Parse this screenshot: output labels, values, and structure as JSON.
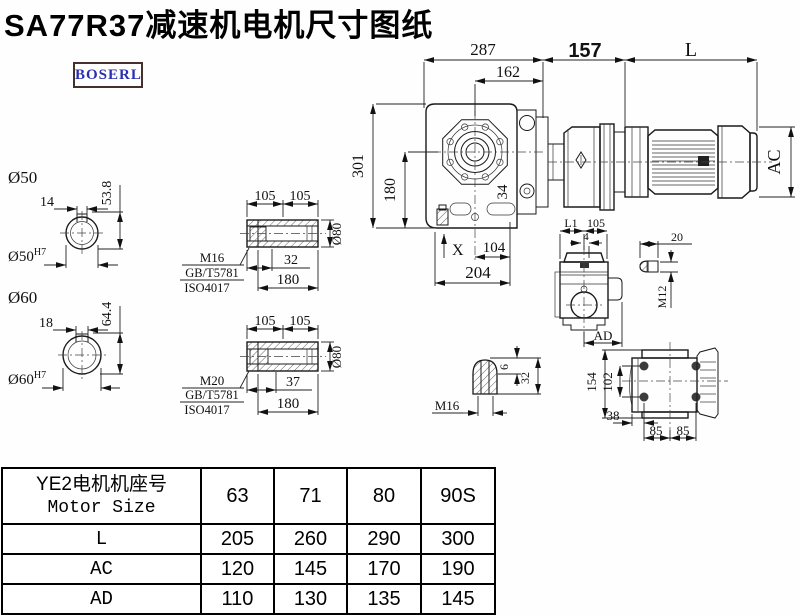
{
  "title": "SA77R37减速机电机尺寸图纸",
  "logo_text": "BOSERL",
  "main_view": {
    "dim_287": "287",
    "dim_162": "162",
    "dim_157": "157",
    "dim_L": "L",
    "dim_301": "301",
    "dim_180": "180",
    "dim_X": "X",
    "dim_104": "104",
    "dim_204": "204",
    "dim_34": "34",
    "dim_AC": "AC"
  },
  "shaft_section_50": {
    "label": "Ø50",
    "key_width": "14",
    "height": "53.8",
    "bore": "Ø50",
    "bore_tol": "H7"
  },
  "shaft_section_60": {
    "label": "Ø60",
    "key_width": "18",
    "height": "64.4",
    "bore": "Ø60",
    "bore_tol": "H7"
  },
  "hollow_shaft_1": {
    "dim_a": "105",
    "dim_b": "105",
    "thread": "M16",
    "std_1": "GB/T5781",
    "std_2": "ISO4017",
    "depth": "32",
    "length": "180",
    "dia": "Ø80"
  },
  "hollow_shaft_2": {
    "dim_a": "105",
    "dim_b": "105",
    "thread": "M20",
    "std_1": "GB/T5781",
    "std_2": "ISO4017",
    "depth": "37",
    "length": "180",
    "dia": "Ø80"
  },
  "side_view": {
    "dim_l1": "L1",
    "dim_w": "105",
    "dim_offset": "4",
    "dim_ad": "AD"
  },
  "key_detail": {
    "dim_len": "20",
    "thread": "M12"
  },
  "plug_detail": {
    "thread": "M16",
    "dim_tip": "6",
    "dim_len": "32"
  },
  "flange_view": {
    "dim_h": "154",
    "dim_inner": "102",
    "dim_offset": "38",
    "dim_p1": "85",
    "dim_p2": "85"
  },
  "table": {
    "header_line1": "YE2电机机座号",
    "header_line2": "Motor Size",
    "col_headers": [
      "63",
      "71",
      "80",
      "90S"
    ],
    "rows": [
      {
        "label": "L",
        "values": [
          "205",
          "260",
          "290",
          "300"
        ]
      },
      {
        "label": "AC",
        "values": [
          "120",
          "145",
          "170",
          "190"
        ]
      },
      {
        "label": "AD",
        "values": [
          "110",
          "130",
          "135",
          "145"
        ]
      }
    ]
  }
}
